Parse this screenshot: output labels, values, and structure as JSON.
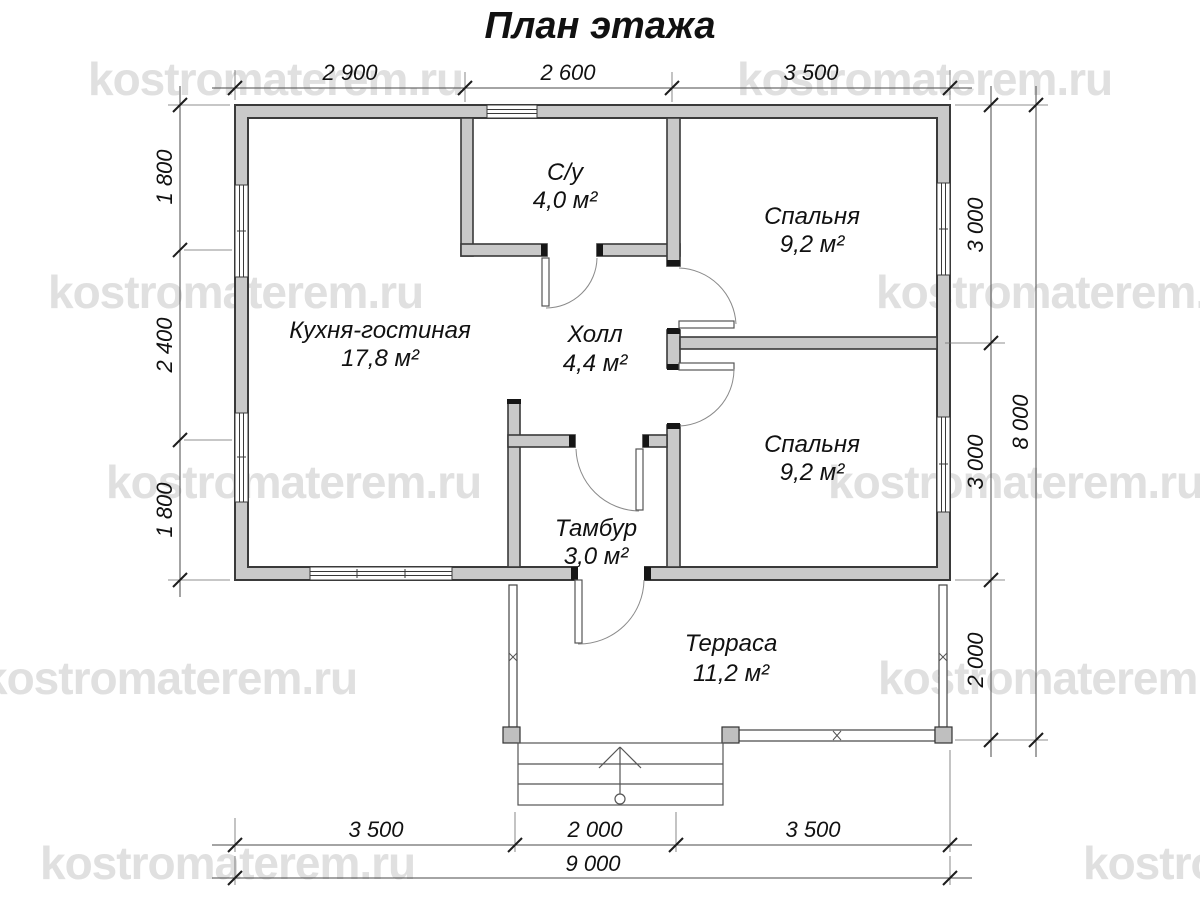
{
  "title": "План этажа",
  "watermark": {
    "text": "kostromaterem.ru"
  },
  "rooms": [
    {
      "name": "С/у",
      "area": "4,0 м²"
    },
    {
      "name": "Спальня",
      "area": "9,2 м²"
    },
    {
      "name": "Кухня-гостиная",
      "area": "17,8 м²"
    },
    {
      "name": "Холл",
      "area": "4,4 м²"
    },
    {
      "name": "Спальня",
      "area": "9,2 м²"
    },
    {
      "name": "Тамбур",
      "area": "3,0 м²"
    },
    {
      "name": "Терраса",
      "area": "11,2 м²"
    }
  ],
  "dimensions": {
    "top": [
      "2 900",
      "2 600",
      "3 500"
    ],
    "left": [
      "1 800",
      "2 400",
      "1 800"
    ],
    "right": [
      "3 000",
      "3 000",
      "2 000"
    ],
    "right_total": "8 000",
    "bottom": [
      "3 500",
      "2 000",
      "3 500"
    ],
    "bottom_total": "9 000"
  }
}
